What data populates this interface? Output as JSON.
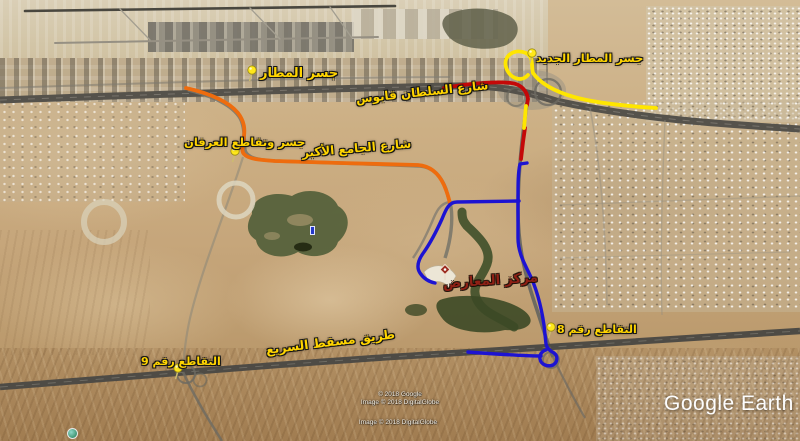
{
  "branding": {
    "logo_text": "Google Earth"
  },
  "attribution": {
    "line1": "© 2018 Google",
    "line2": "Image © 2018 DigitalGlobe",
    "line3": "Image © 2018 DigitalGlobe"
  },
  "labels": {
    "airport_bridge": {
      "text": "جسر المطار",
      "color": "#ffd400"
    },
    "new_airport_bridge": {
      "text": "جسر المطار الجديد",
      "color": "#ffd400"
    },
    "sultan_qaboos_street": {
      "text": "شارع السلطان قابوس",
      "color": "#ffd400"
    },
    "irfan_bridge": {
      "text": "جسر وتقاطع العرفان",
      "color": "#ffd400"
    },
    "grand_mosque_street": {
      "text": "شارع الجامع الأكبر",
      "color": "#ffd400"
    },
    "exhibition_center": {
      "text": "مركز المعارض",
      "color": "#8e2015"
    },
    "intersection_8": {
      "text": "التقاطع رقم 8",
      "color": "#ffd400"
    },
    "intersection_9": {
      "text": "التقاطع رقم 9",
      "color": "#ffd400"
    },
    "muscat_expressway": {
      "text": "طريق مسقط السريع",
      "color": "#ffd400"
    }
  },
  "routes": {
    "yellow": {
      "name": "new-airport-bridge-route",
      "color": "#ffe600"
    },
    "red": {
      "name": "sultan-qaboos-route",
      "color": "#c40808"
    },
    "orange": {
      "name": "grand-mosque-route",
      "color": "#ee6c0e"
    },
    "blue": {
      "name": "exhibition-center-route",
      "color": "#1d13d2"
    }
  }
}
